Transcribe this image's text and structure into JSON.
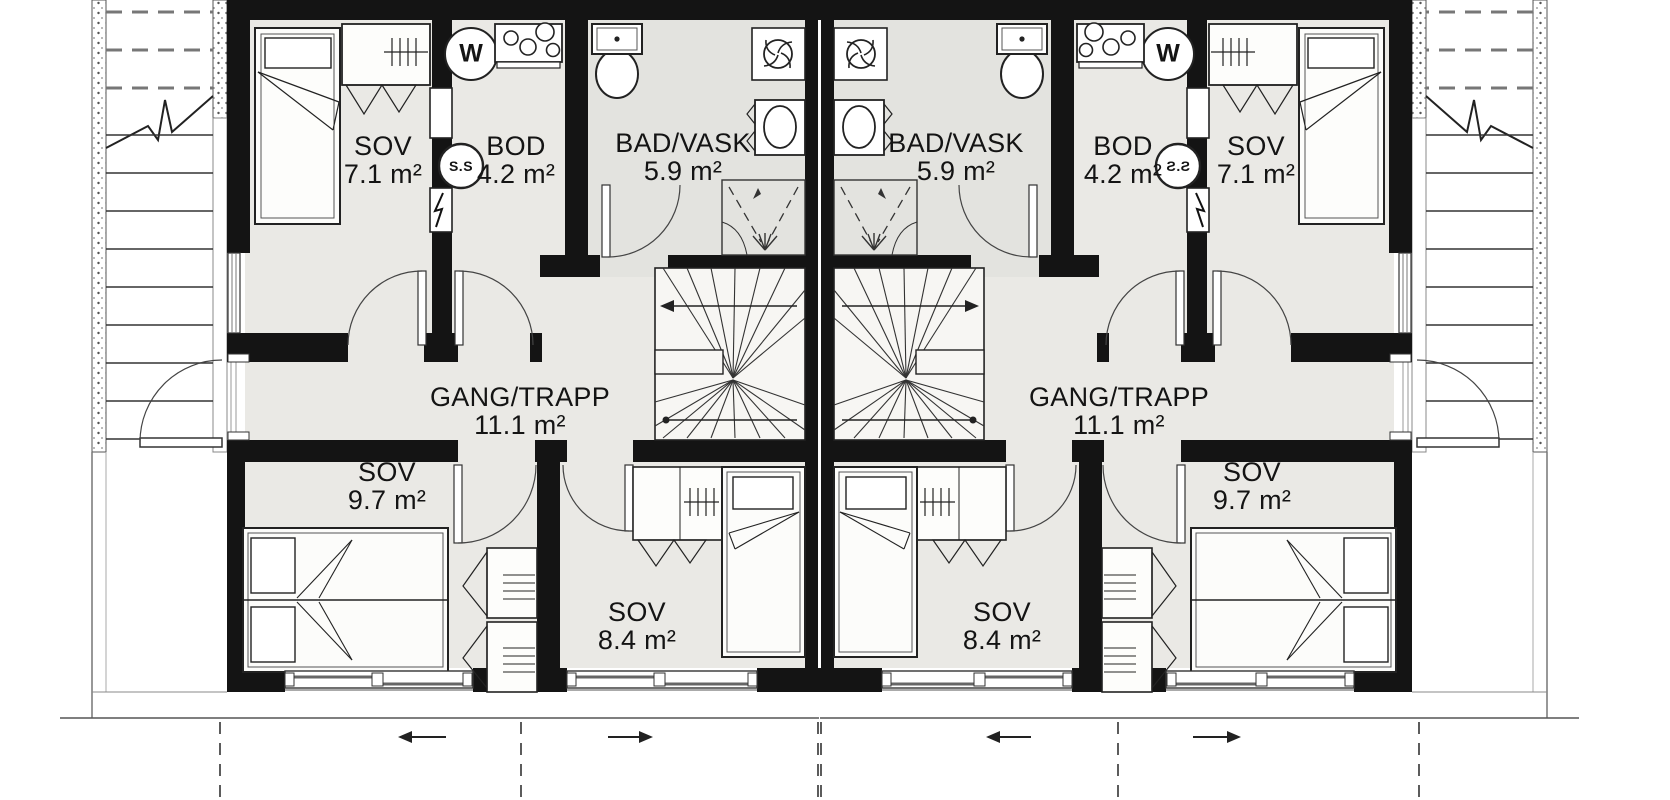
{
  "floorplan": {
    "units": [
      {
        "side": "left",
        "rooms": [
          {
            "name": "SOV",
            "area": "7.1 m²"
          },
          {
            "name": "BOD",
            "area": "4.2 m²"
          },
          {
            "name": "BAD/VASK",
            "area": "5.9 m²"
          },
          {
            "name": "GANG/TRAPP",
            "area": "11.1 m²"
          },
          {
            "name": "SOV",
            "area": "9.7 m²"
          },
          {
            "name": "SOV",
            "area": "8.4 m²"
          }
        ],
        "symbols": {
          "water_heater_label": "W",
          "fuse_box_label": "S.S"
        }
      },
      {
        "side": "right",
        "rooms": [
          {
            "name": "SOV",
            "area": "7.1 m²"
          },
          {
            "name": "BOD",
            "area": "4.2 m²"
          },
          {
            "name": "BAD/VASK",
            "area": "5.9 m²"
          },
          {
            "name": "GANG/TRAPP",
            "area": "11.1 m²"
          },
          {
            "name": "SOV",
            "area": "9.7 m²"
          },
          {
            "name": "SOV",
            "area": "8.4 m²"
          }
        ],
        "symbols": {
          "water_heater_label": "W",
          "fuse_box_label": "S.S"
        }
      }
    ],
    "colors": {
      "wall": "#141414",
      "floor": "#eae9e5",
      "bath_floor": "#e3e3df",
      "stair_fill": "#f7f6f3"
    }
  }
}
